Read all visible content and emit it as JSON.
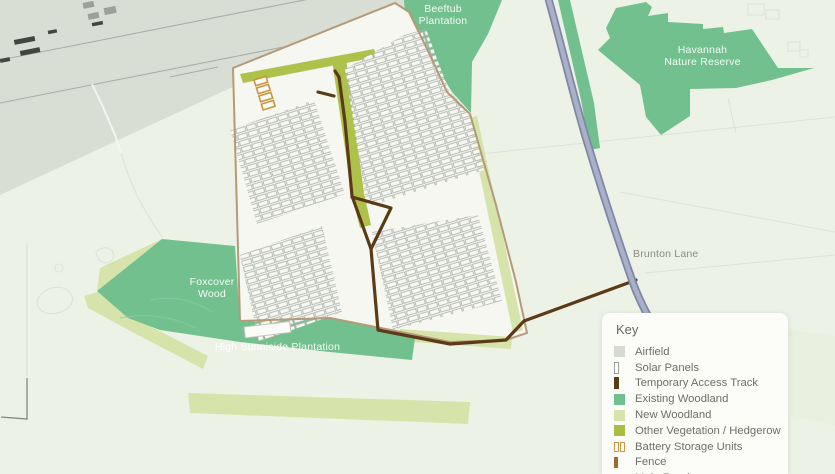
{
  "map": {
    "labels": {
      "beeftub_line1": "Beeftub",
      "beeftub_line2": "Plantation",
      "havannah_line1": "Havannah",
      "havannah_line2": "Nature Reserve",
      "foxcover_line1": "Foxcover",
      "foxcover_line2": "Wood",
      "sunniside": "High Sunniside Plantation",
      "brunton": "Brunton Lane"
    },
    "colors": {
      "background": "#edf2e7",
      "site_interior": "#f6f7f0",
      "airfield": "#d9ded5",
      "existing_woodland": "#70c08f",
      "new_woodland": "#d6e3ab",
      "hedgerow": "#aec14b",
      "track": "#5b3a18",
      "fence": "#b59a79",
      "road": "#8a93b0",
      "battery": "#cc9440"
    }
  },
  "legend": {
    "title": "Key",
    "items": [
      {
        "label": "Airfield",
        "type": "square",
        "color": "#d7dad3"
      },
      {
        "label": "Solar Panels",
        "type": "vrect",
        "color": "#ffffff",
        "border": "#9aa39a"
      },
      {
        "label": "Temporary Access Track",
        "type": "vrect",
        "color": "#5b3a18"
      },
      {
        "label": "Existing Woodland",
        "type": "square",
        "color": "#70c08f"
      },
      {
        "label": "New Woodland",
        "type": "square",
        "color": "#d6e3ab"
      },
      {
        "label": "Other Vegetation / Hedgerow",
        "type": "square",
        "color": "#a9bd42"
      },
      {
        "label": "Battery Storage Units",
        "type": "battery",
        "color": "#cc9440"
      },
      {
        "label": "Fence",
        "type": "vrect-small",
        "color": "#9c6b33"
      },
      {
        "label": "Main Road",
        "type": "road",
        "color": "#98a3bf"
      }
    ]
  }
}
